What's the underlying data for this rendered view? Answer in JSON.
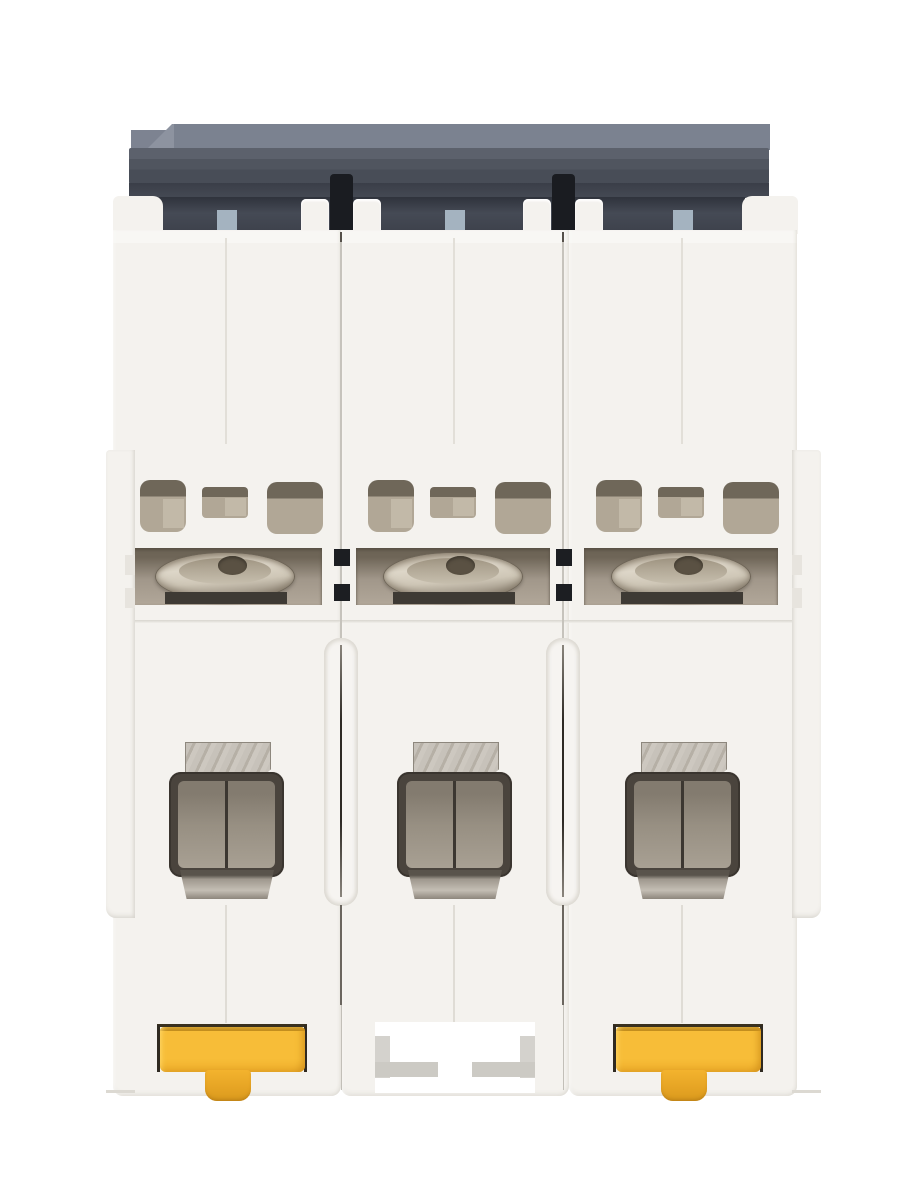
{
  "meta": {
    "type": "product-photograph",
    "subject": "3-pole DIN-rail miniature circuit breaker viewed from the rear/bottom",
    "visible_text": "none"
  },
  "product": {
    "pole_count": 3,
    "orientation": "rear view, DIN-rail mounting side facing camera",
    "modules": [
      {
        "label": "pole-1",
        "din_clip": "yellow T-shaped release clip"
      },
      {
        "label": "pole-2",
        "din_clip": "open latch notch (no clip)"
      },
      {
        "label": "pole-3",
        "din_clip": "yellow T-shaped release clip"
      }
    ],
    "features": [
      "dark slate housing cap with stepped profile",
      "black inter-module clips at the cap",
      "blue-gray guide tabs at each module center",
      "rounded ventilation openings per module",
      "recessed metallic terminal screw per module",
      "box-clamp wire terminal with metal tab per module",
      "vertical seam channels between modules",
      "side flanges with notches on outer edges"
    ]
  },
  "colors": {
    "background": "#ffffff",
    "body_white": "#f4f2ee",
    "seam_line": "#c6c3bc",
    "seam_dark": "#55504a",
    "header_top_face": "#7b8290",
    "header_recess": "#3d414b",
    "clip_black": "#1a1c21",
    "guide_blue_gray": "#a4b3c0",
    "vent_interior": "#b1a796",
    "vent_shadow": "#6f6759",
    "screw_recess": "#a1978a",
    "screw_metal_light": "#ddd6c8",
    "screw_metal_dark": "#8b8172",
    "terminal_frame": "#4a443d",
    "terminal_inner": "#978f82",
    "din_clip_yellow": "#f7bd38",
    "din_clip_shadow": "#d89a1e",
    "clip_recess_line": "#2f2a21"
  }
}
